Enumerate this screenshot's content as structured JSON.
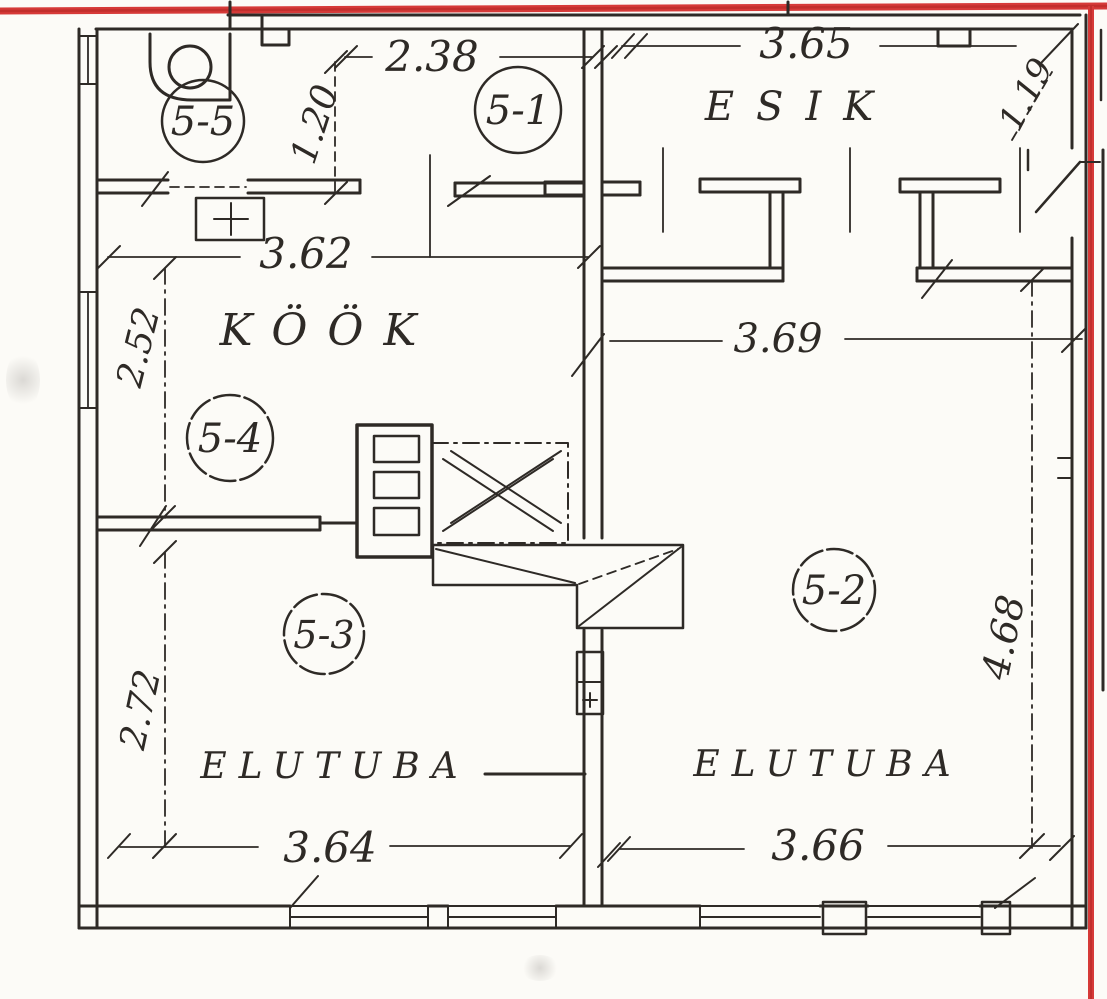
{
  "scan": {
    "paper_color": "#fcfbf7",
    "border_color": "#d63a38",
    "ink_color": "#2e2a26"
  },
  "room_labels": {
    "esik": "ESIK",
    "kook": "KÖÖK",
    "elutuba_left": "ELUTUBA",
    "elutuba_right": "ELUTUBA"
  },
  "room_numbers": {
    "n51": "5-1",
    "n52": "5-2",
    "n53": "5-3",
    "n54": "5-4",
    "n55": "5-5"
  },
  "dimensions": {
    "d238": "2.38",
    "d365": "3.65",
    "d120": "1.20",
    "d119": "1.19",
    "d362": "3.62",
    "d252": "2.52",
    "d369": "3.69",
    "d272": "2.72",
    "d468": "4.68",
    "d364": "3.64",
    "d366": "3.66"
  }
}
